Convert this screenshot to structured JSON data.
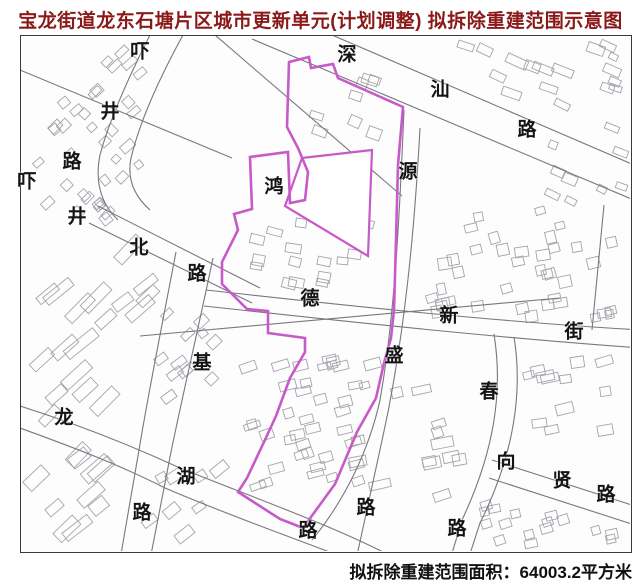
{
  "title": "宝龙街道龙东石塘片区城市更新单元(计划调整) 拟拆除重建范围示意图",
  "footer": {
    "area_text": "拟拆除重建范围面积：64003.2平方米"
  },
  "colors": {
    "title_text": "#8a1a1a",
    "footer_text": "#111111",
    "boundary_magenta": "#c65ac8",
    "road_line": "#77777e",
    "building_line": "#a4a4ac"
  },
  "map": {
    "boundary_name": "拟拆除重建范围",
    "area_value": "64003.2平方米",
    "road_labels": [
      {
        "name": "xiajing-road",
        "chars": [
          {
            "t": "吓",
            "x": 140,
            "y": 52
          },
          {
            "t": "井",
            "x": 110,
            "y": 112
          },
          {
            "t": "路",
            "x": 72,
            "y": 162
          }
        ]
      },
      {
        "name": "xiajingbei-road",
        "chars": [
          {
            "t": "吓",
            "x": 27,
            "y": 182
          },
          {
            "t": "井",
            "x": 77,
            "y": 217
          },
          {
            "t": "北",
            "x": 139,
            "y": 248
          },
          {
            "t": "路",
            "x": 197,
            "y": 274
          }
        ]
      },
      {
        "name": "shenshan-road",
        "chars": [
          {
            "t": "深",
            "x": 347,
            "y": 55
          },
          {
            "t": "汕",
            "x": 440,
            "y": 90
          },
          {
            "t": "路",
            "x": 527,
            "y": 130
          }
        ]
      },
      {
        "name": "hong-label",
        "chars": [
          {
            "t": "鸿",
            "x": 274,
            "y": 187
          }
        ]
      },
      {
        "name": "yuansheng-road",
        "chars": [
          {
            "t": "源",
            "x": 408,
            "y": 172
          },
          {
            "t": "盛",
            "x": 394,
            "y": 356
          },
          {
            "t": "路",
            "x": 366,
            "y": 508
          }
        ]
      },
      {
        "name": "dexin-street",
        "chars": [
          {
            "t": "德",
            "x": 310,
            "y": 299
          },
          {
            "t": "新",
            "x": 449,
            "y": 316
          },
          {
            "t": "街",
            "x": 574,
            "y": 332
          }
        ]
      },
      {
        "name": "ji-road",
        "chars": [
          {
            "t": "基",
            "x": 202,
            "y": 363
          },
          {
            "t": "路",
            "x": 142,
            "y": 513
          }
        ]
      },
      {
        "name": "longhu-road",
        "chars": [
          {
            "t": "龙",
            "x": 64,
            "y": 418
          },
          {
            "t": "湖",
            "x": 186,
            "y": 477
          },
          {
            "t": "路",
            "x": 308,
            "y": 531
          }
        ]
      },
      {
        "name": "chun-road",
        "chars": [
          {
            "t": "春",
            "x": 489,
            "y": 392
          },
          {
            "t": "路",
            "x": 457,
            "y": 529
          }
        ]
      },
      {
        "name": "xiangxian-road",
        "chars": [
          {
            "t": "向",
            "x": 506,
            "y": 462
          },
          {
            "t": "贤",
            "x": 562,
            "y": 481
          },
          {
            "t": "路",
            "x": 606,
            "y": 495
          }
        ]
      }
    ]
  }
}
